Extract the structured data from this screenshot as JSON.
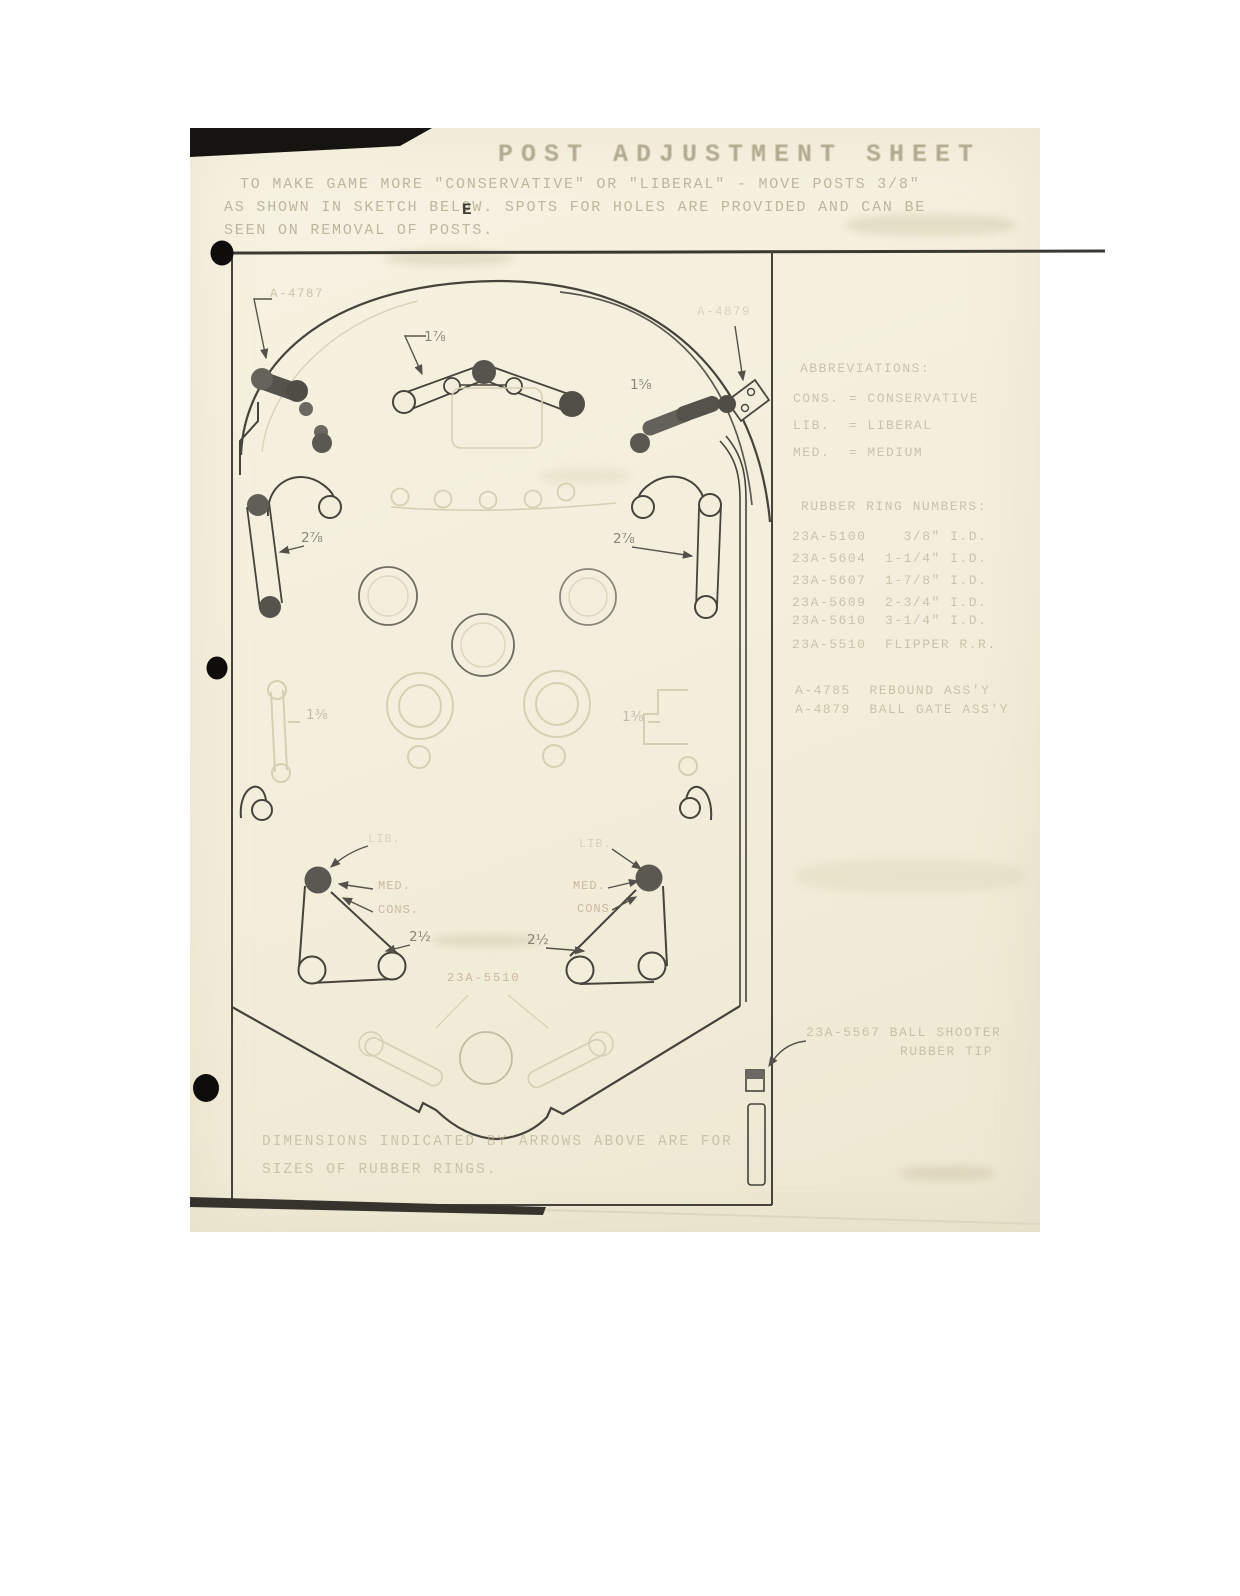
{
  "page": {
    "title": "POST ADJUSTMENT SHEET",
    "intro_line1": "TO MAKE GAME MORE \"CONSERVATIVE\" OR \"LIBERAL\" - MOVE POSTS 3/8\"",
    "intro_line2": "AS SHOWN IN SKETCH BELOW. SPOTS FOR HOLES ARE PROVIDED AND CAN BE",
    "intro_line3": "SEEN ON REMOVAL OF POSTS.",
    "margin_mark": "E",
    "footer_line1": "DIMENSIONS INDICATED BY ARROWS ABOVE ARE FOR",
    "footer_line2": "SIZES OF RUBBER RINGS."
  },
  "abbreviations": {
    "heading": "ABBREVIATIONS:",
    "items": [
      "CONS. = CONSERVATIVE",
      "LIB.  = LIBERAL",
      "MED.  = MEDIUM"
    ]
  },
  "rubber_rings": {
    "heading": "RUBBER RING NUMBERS:",
    "items": [
      "23A-5100    3/8\" I.D.",
      "23A-5604  1-1/4\" I.D.",
      "23A-5607  1-7/8\" I.D.",
      "23A-5609  2-3/4\" I.D.",
      "23A-5610  3-1/4\" I.D.",
      "23A-5510  FLIPPER R.R."
    ]
  },
  "assemblies": {
    "rebound": "A-4785  REBOUND ASS'Y",
    "ballgate": "A-4879  BALL GATE ASS'Y"
  },
  "shooter": {
    "label_line1": "23A-5567 BALL SHOOTER",
    "label_line2": "RUBBER TIP"
  },
  "diagram_labels": {
    "top_left_post": "A-4787",
    "top_right_gate": "A-4879",
    "top_lane_dim": "1⅞",
    "gate_dim": "1⅝",
    "left_band_dim": "2⅞",
    "right_band_dim": "2⅞",
    "left_mid_dim": "1⅜",
    "right_mid_dim": "1⅜",
    "flipper_ring": "23A-5510",
    "sling_lib": "LIB.",
    "sling_med": "MED.",
    "sling_cons": "CONS.",
    "sling_dim": "2½"
  },
  "colors": {
    "page_bg": "#f3eedb",
    "ink_dark": "#45433b",
    "ink_faded": "#b3ac92",
    "label_red": "#b5977f",
    "post_fill": "#5b5851",
    "ghost": "#d5cfb4",
    "punch_hole": "#0e0d0b"
  }
}
